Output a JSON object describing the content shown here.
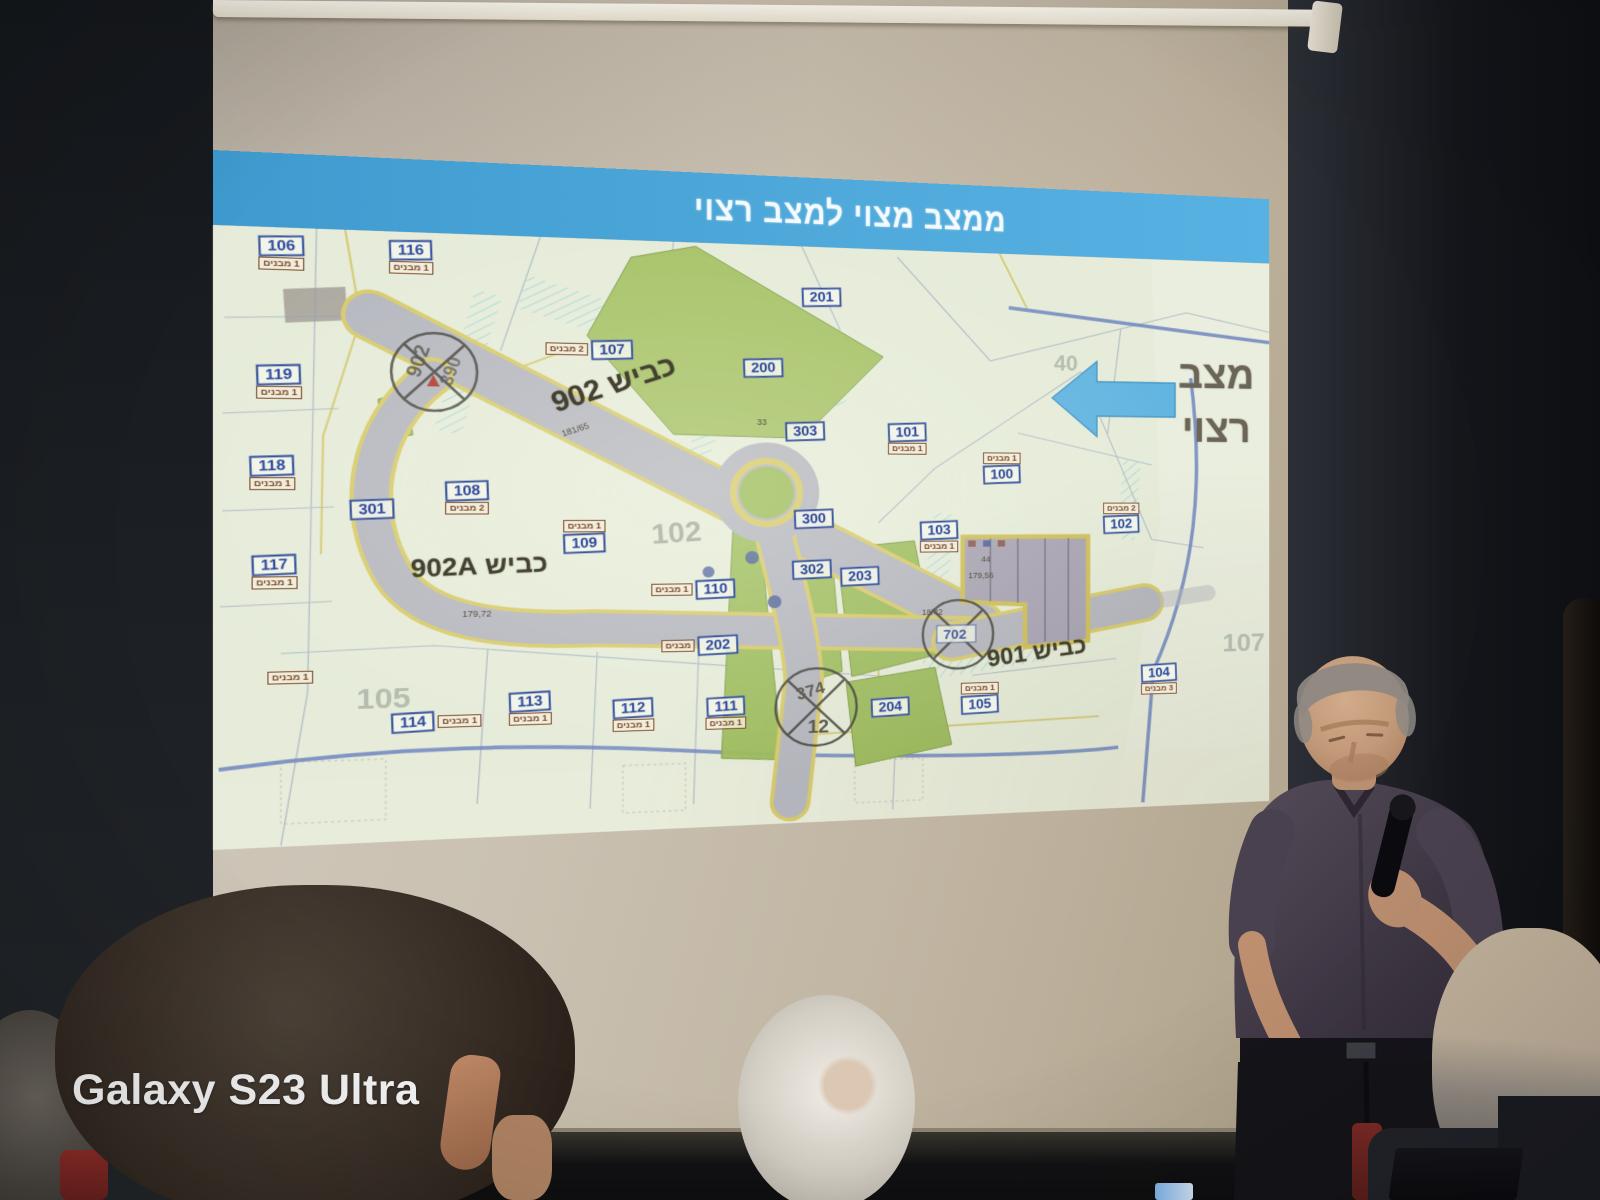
{
  "watermark": {
    "label": "Galaxy S23 Ultra"
  },
  "slide": {
    "title": "ממצב מצוי למצב רצוי",
    "side_note": {
      "line1": "מצב",
      "line2": "רצוי"
    },
    "colors": {
      "banner_blue": "#4aa6d8",
      "arrow_blue": "#5fb6e3",
      "map_background": "#e6ecd8",
      "road_gray": "#b5b7bf",
      "road_edge_yellow": "#d8ca67",
      "green_area": "#a5c263",
      "plot_label_blue": "#3a55a0",
      "tag_brown": "#7a4a28"
    },
    "roads": [
      {
        "label": "כביש 902"
      },
      {
        "label": "כביש 902A"
      },
      {
        "label": "כביש 901"
      }
    ],
    "plots": [
      {
        "id": "106",
        "tag": "1 מבנים"
      },
      {
        "id": "116",
        "tag": "1 מבנים"
      },
      {
        "id": "201",
        "tag": ""
      },
      {
        "id": "107",
        "tag": "2 מבנים"
      },
      {
        "id": "200",
        "tag": ""
      },
      {
        "id": "119",
        "tag": "1 מבנים"
      },
      {
        "id": "303",
        "tag": ""
      },
      {
        "id": "101",
        "tag": "1 מבנים"
      },
      {
        "id": "100",
        "tag": "1 מבנים"
      },
      {
        "id": "118",
        "tag": "1 מבנים"
      },
      {
        "id": "301",
        "tag": ""
      },
      {
        "id": "108",
        "tag": "2 מבנים"
      },
      {
        "id": "109",
        "tag": "1 מבנים"
      },
      {
        "id": "103",
        "tag": "1 מבנים"
      },
      {
        "id": "102",
        "tag": "2 מבנים"
      },
      {
        "id": "117",
        "tag": "1 מבנים"
      },
      {
        "id": "110",
        "tag": "1 מבנים"
      },
      {
        "id": "300",
        "tag": ""
      },
      {
        "id": "302",
        "tag": ""
      },
      {
        "id": "203",
        "tag": ""
      },
      {
        "id": "202",
        "tag": "מבנים"
      },
      {
        "id": "104",
        "tag": "3 מבנים"
      },
      {
        "id": "105",
        "tag": "1 מבנים"
      },
      {
        "id": "204",
        "tag": ""
      },
      {
        "id": "113",
        "tag": "1 מבנים"
      },
      {
        "id": "112",
        "tag": "1 מבנים"
      },
      {
        "id": "111",
        "tag": "1 מבנים"
      },
      {
        "id": "114",
        "tag": "1 מבנים"
      }
    ],
    "stray_tag": "1 מבנים",
    "big_numbers": [
      "102",
      "105",
      "107",
      "40"
    ],
    "annotations": [
      "44",
      "179,56",
      "179,72",
      "181/65",
      "18/42",
      "33"
    ],
    "junctions": {
      "j1a": "902",
      "j1b": "390",
      "j2a": "374",
      "j2b": "12",
      "j3": "702"
    }
  }
}
